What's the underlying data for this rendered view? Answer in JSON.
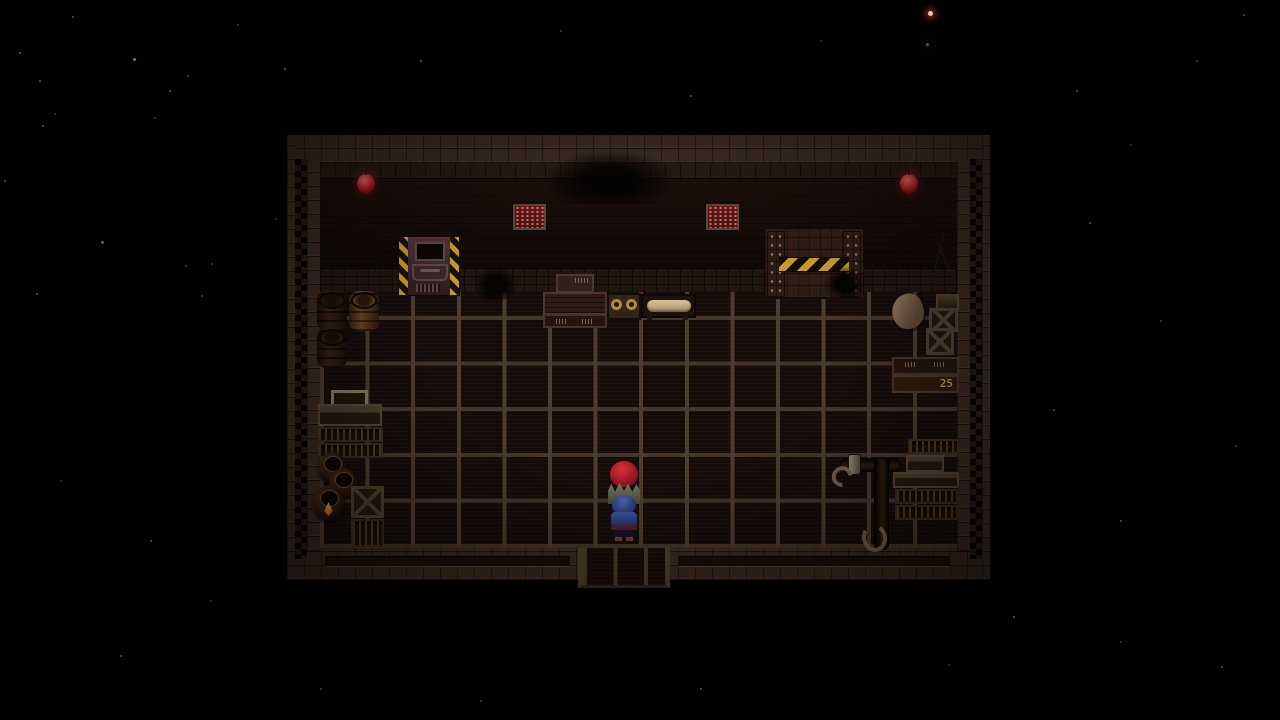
{
  "meta": {
    "scene_label": "warehouse-room",
    "game_style": "top-down-rpg"
  },
  "background": {
    "color": "#020101",
    "stars": [
      {
        "x": 928,
        "y": 11,
        "s": 5,
        "c": "#e8c2b8",
        "glow": true
      },
      {
        "x": 926,
        "y": 43,
        "s": 3,
        "c": "#a03028"
      },
      {
        "x": 133,
        "y": 58,
        "s": 3,
        "c": "#8a6a58"
      },
      {
        "x": 19,
        "y": 52,
        "s": 2,
        "c": "#6a5a50"
      },
      {
        "x": 72,
        "y": 16,
        "s": 2,
        "c": "#5a4a42"
      },
      {
        "x": 39,
        "y": 80,
        "s": 2,
        "c": "#5a4a42"
      },
      {
        "x": 237,
        "y": 24,
        "s": 2,
        "c": "#4a3a34"
      },
      {
        "x": 187,
        "y": 75,
        "s": 2,
        "c": "#5a4a42"
      },
      {
        "x": 284,
        "y": 68,
        "s": 2,
        "c": "#6a5a50"
      },
      {
        "x": 54,
        "y": 113,
        "s": 2,
        "c": "#4a3a34"
      },
      {
        "x": 42,
        "y": 125,
        "s": 2,
        "c": "#5a4a42"
      },
      {
        "x": 154,
        "y": 117,
        "s": 2,
        "c": "#4a3a34"
      },
      {
        "x": 169,
        "y": 90,
        "s": 2,
        "c": "#5a4a42"
      },
      {
        "x": 101,
        "y": 241,
        "s": 3,
        "c": "#7a5a50"
      },
      {
        "x": 4,
        "y": 180,
        "s": 2,
        "c": "#5a4a42"
      },
      {
        "x": 211,
        "y": 263,
        "s": 2,
        "c": "#4a3a34"
      },
      {
        "x": 36,
        "y": 293,
        "s": 2,
        "c": "#5a4a42"
      },
      {
        "x": 201,
        "y": 295,
        "s": 2,
        "c": "#4a3a34"
      },
      {
        "x": 185,
        "y": 265,
        "s": 2,
        "c": "#4a3a34"
      },
      {
        "x": 275,
        "y": 218,
        "s": 2,
        "c": "#5a4a42"
      },
      {
        "x": 420,
        "y": 60,
        "s": 2,
        "c": "#6a5a50"
      },
      {
        "x": 560,
        "y": 30,
        "s": 2,
        "c": "#4a3a34"
      },
      {
        "x": 690,
        "y": 95,
        "s": 2,
        "c": "#5a4a42"
      },
      {
        "x": 820,
        "y": 40,
        "s": 2,
        "c": "#4a3a34"
      },
      {
        "x": 1076,
        "y": 90,
        "s": 2,
        "c": "#5a4a42"
      },
      {
        "x": 1130,
        "y": 144,
        "s": 2,
        "c": "#4a3a34"
      },
      {
        "x": 1243,
        "y": 14,
        "s": 2,
        "c": "#5a4a42"
      },
      {
        "x": 1196,
        "y": 60,
        "s": 2,
        "c": "#4a3a34"
      },
      {
        "x": 1089,
        "y": 222,
        "s": 2,
        "c": "#5a4a42"
      },
      {
        "x": 1160,
        "y": 320,
        "s": 2,
        "c": "#4a3a34"
      },
      {
        "x": 1053,
        "y": 409,
        "s": 2,
        "c": "#5a4a42"
      },
      {
        "x": 1235,
        "y": 445,
        "s": 2,
        "c": "#4a3a34"
      },
      {
        "x": 1120,
        "y": 520,
        "s": 2,
        "c": "#5a4a42"
      },
      {
        "x": 1013,
        "y": 616,
        "s": 2,
        "c": "#6a5a50"
      },
      {
        "x": 1120,
        "y": 641,
        "s": 2,
        "c": "#4a3a34"
      },
      {
        "x": 1221,
        "y": 666,
        "s": 2,
        "c": "#5a4a42"
      },
      {
        "x": 948,
        "y": 664,
        "s": 2,
        "c": "#4a3a34"
      },
      {
        "x": 210,
        "y": 600,
        "s": 2,
        "c": "#4a3a34"
      },
      {
        "x": 120,
        "y": 655,
        "s": 2,
        "c": "#5a4a42"
      },
      {
        "x": 320,
        "y": 688,
        "s": 2,
        "c": "#4a3a34"
      },
      {
        "x": 480,
        "y": 700,
        "s": 2,
        "c": "#4a3a34"
      },
      {
        "x": 700,
        "y": 688,
        "s": 2,
        "c": "#5a4a42"
      },
      {
        "x": 60,
        "y": 480,
        "s": 2,
        "c": "#4a3a34"
      },
      {
        "x": 150,
        "y": 540,
        "s": 2,
        "c": "#5a4a42"
      }
    ]
  },
  "scene": {
    "room": {
      "x": 287,
      "y": 135,
      "w": 703,
      "h": 445
    },
    "labels": {
      "crate_quantity": "25"
    },
    "colors": {
      "hazard_yellow": "#c49a28",
      "lamp_red": "#b52a2e",
      "vent_red": "#7e2222",
      "floor_grout": "#4e3c30",
      "floor_tile": "#150c0a",
      "wall_dark": "#120a08",
      "brick": "#3b2b22",
      "player_blue": "#3c55a0",
      "npc_hair_red": "#b01c28"
    },
    "props": [
      {
        "name": "ceiling-lamp-left",
        "type": "lamp",
        "x": 357,
        "y": 174,
        "w": 18,
        "h": 19
      },
      {
        "name": "ceiling-lamp-right",
        "type": "lamp",
        "x": 900,
        "y": 174,
        "w": 18,
        "h": 19
      },
      {
        "name": "wall-vent-left",
        "type": "vent",
        "x": 513,
        "y": 204,
        "w": 29,
        "h": 22
      },
      {
        "name": "wall-vent-right",
        "type": "vent",
        "x": 706,
        "y": 204,
        "w": 29,
        "h": 22
      },
      {
        "name": "ceiling-shadow",
        "type": "mound",
        "x": 545,
        "y": 150,
        "w": 130,
        "h": 54
      },
      {
        "name": "metal-locker",
        "type": "locker",
        "x": 398,
        "y": 236,
        "w": 60,
        "h": 58,
        "parts": [
          "window",
          "drawer",
          "grill"
        ]
      },
      {
        "name": "cargo-door",
        "type": "bigdoor",
        "x": 764,
        "y": 228,
        "w": 98,
        "h": 69,
        "parts": [
          "pillar-left",
          "pillar-right",
          "stripe"
        ]
      },
      {
        "name": "wall-branches",
        "type": "branches",
        "x": 922,
        "y": 232,
        "w": 34,
        "h": 62
      },
      {
        "name": "floor-shadow-left",
        "type": "mound",
        "x": 474,
        "y": 266,
        "w": 44,
        "h": 34
      },
      {
        "name": "floor-shadow-right",
        "type": "mound",
        "x": 824,
        "y": 266,
        "w": 42,
        "h": 32
      },
      {
        "name": "wall-cabinet-top",
        "type": "cabinet-small",
        "x": 556,
        "y": 274,
        "w": 38,
        "h": 19
      },
      {
        "name": "wall-cabinet",
        "type": "cabinet",
        "x": 543,
        "y": 292,
        "w": 64,
        "h": 23
      },
      {
        "name": "wall-drawers",
        "type": "drawers",
        "x": 543,
        "y": 314,
        "w": 64,
        "h": 14
      },
      {
        "name": "rope-table",
        "type": "coil-table",
        "x": 607,
        "y": 293,
        "w": 34,
        "h": 27
      },
      {
        "name": "bench-with-body",
        "type": "bench-body",
        "x": 641,
        "y": 294,
        "w": 55,
        "h": 24,
        "parts": [
          "body"
        ]
      },
      {
        "name": "barrel-dark-1",
        "type": "barrel-dark",
        "x": 317,
        "y": 291,
        "w": 30,
        "h": 40
      },
      {
        "name": "barrel-brown",
        "type": "barrel-brown",
        "x": 349,
        "y": 291,
        "w": 30,
        "h": 40
      },
      {
        "name": "barrel-dark-2",
        "type": "barrel-dark",
        "x": 317,
        "y": 328,
        "w": 30,
        "h": 40
      },
      {
        "name": "tray-shelf",
        "type": "tray",
        "x": 331,
        "y": 390,
        "w": 37,
        "h": 20
      },
      {
        "name": "side-table",
        "type": "shelf-plain",
        "x": 318,
        "y": 404,
        "w": 64,
        "h": 22
      },
      {
        "name": "bottle-rack-1",
        "type": "shelf-bottles",
        "x": 317,
        "y": 427,
        "w": 66,
        "h": 15
      },
      {
        "name": "bottle-rack-2",
        "type": "shelf-bottles",
        "x": 317,
        "y": 443,
        "w": 66,
        "h": 15
      },
      {
        "name": "clay-pot-1",
        "type": "pot",
        "x": 318,
        "y": 452,
        "w": 28,
        "h": 32
      },
      {
        "name": "clay-pot-2",
        "type": "pot",
        "x": 329,
        "y": 468,
        "w": 28,
        "h": 32
      },
      {
        "name": "clay-pot-flammable",
        "type": "pot-flame",
        "x": 313,
        "y": 485,
        "w": 31,
        "h": 36
      },
      {
        "name": "crate-x-left",
        "type": "crate",
        "x": 351,
        "y": 486,
        "w": 33,
        "h": 32
      },
      {
        "name": "bottle-rack-3",
        "type": "shelf-bottles",
        "x": 351,
        "y": 519,
        "w": 33,
        "h": 28
      },
      {
        "name": "supply-sack",
        "type": "sack",
        "x": 892,
        "y": 294,
        "w": 32,
        "h": 35
      },
      {
        "name": "crate-lid",
        "type": "crate-top",
        "x": 936,
        "y": 294,
        "w": 23,
        "h": 16
      },
      {
        "name": "crate-x-right-1",
        "type": "crate",
        "x": 929,
        "y": 308,
        "w": 29,
        "h": 24
      },
      {
        "name": "crate-x-right-2",
        "type": "crate",
        "x": 926,
        "y": 328,
        "w": 28,
        "h": 27
      },
      {
        "name": "supply-shelf",
        "type": "drawers",
        "x": 892,
        "y": 357,
        "w": 67,
        "h": 18
      },
      {
        "name": "crate-25",
        "type": "label-crate",
        "x": 892,
        "y": 375,
        "w": 67,
        "h": 18,
        "label": "25"
      },
      {
        "name": "bottle-rack-4",
        "type": "shelf-bottles",
        "x": 908,
        "y": 439,
        "w": 51,
        "h": 15
      },
      {
        "name": "pipe-horizontal",
        "type": "pipe-h",
        "x": 840,
        "y": 458,
        "w": 58,
        "h": 12
      },
      {
        "name": "pipe-collar",
        "type": "pipe-collar",
        "x": 848,
        "y": 454,
        "w": 11,
        "h": 19
      },
      {
        "name": "pipe-vertical",
        "type": "pipe-v",
        "x": 874,
        "y": 458,
        "w": 13,
        "h": 90
      },
      {
        "name": "pipe-hook-left",
        "type": "hook",
        "x": 832,
        "y": 466,
        "w": 20,
        "h": 21
      },
      {
        "name": "pipe-hook-bottom",
        "type": "hook-down",
        "x": 862,
        "y": 524,
        "w": 25,
        "h": 28
      },
      {
        "name": "desk-small",
        "type": "shelf-plain",
        "x": 906,
        "y": 455,
        "w": 38,
        "h": 17
      },
      {
        "name": "desk-long",
        "type": "shelf-plain",
        "x": 893,
        "y": 472,
        "w": 66,
        "h": 16
      },
      {
        "name": "bottle-rack-5",
        "type": "shelf-bottles",
        "x": 895,
        "y": 489,
        "w": 63,
        "h": 15
      },
      {
        "name": "bottle-rack-6",
        "type": "shelf-bottles",
        "x": 895,
        "y": 505,
        "w": 63,
        "h": 15
      },
      {
        "name": "exit-doorway",
        "type": "doorway",
        "x": 578,
        "y": 548,
        "w": 92,
        "h": 40,
        "interactable": true
      },
      {
        "name": "npc-redhead",
        "type": "npc-red",
        "x": 606,
        "y": 461,
        "w": 36,
        "h": 45,
        "interactable": true,
        "parts": [
          "hair",
          "body"
        ]
      },
      {
        "name": "player-character",
        "type": "player-blue",
        "x": 605,
        "y": 495,
        "w": 37,
        "h": 47,
        "interactable": true,
        "parts": [
          "hat",
          "torso",
          "belt",
          "legs",
          "shoes"
        ]
      }
    ]
  }
}
